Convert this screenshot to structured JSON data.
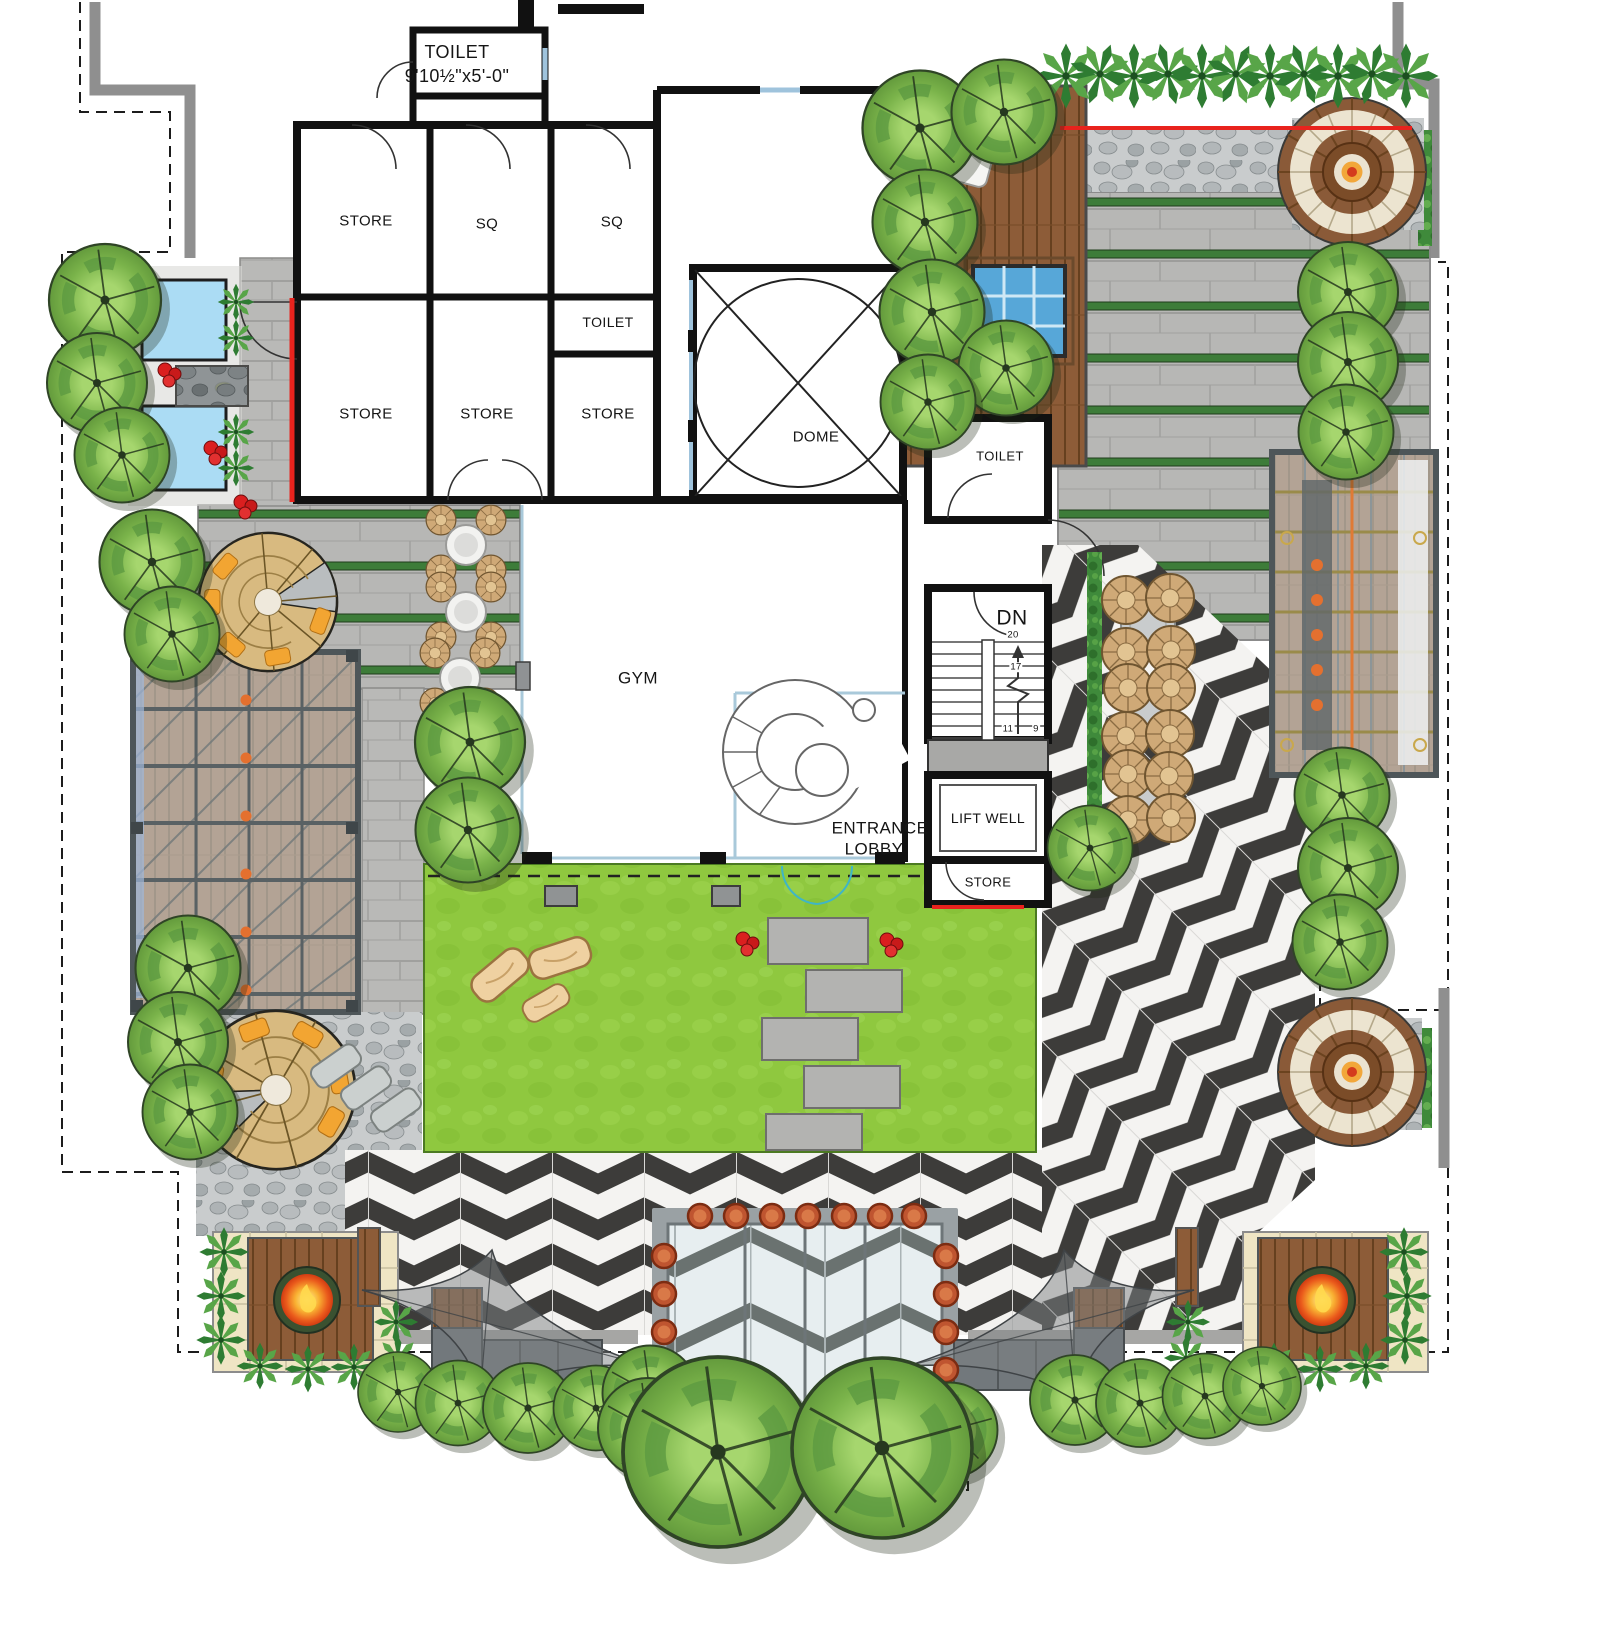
{
  "rooms": {
    "toilet_top": {
      "label": "TOILET",
      "dims": "9'10½\"x5'-0\""
    },
    "store_1": "STORE",
    "sq_1": "SQ",
    "sq_2": "SQ",
    "toilet_mid": "TOILET",
    "store_2": "STORE",
    "store_3": "STORE",
    "store_4": "STORE",
    "dome": "DOME",
    "gym": "GYM",
    "entrance_lobby": {
      "line1": "ENTRANCE",
      "line2": "LOBBY"
    },
    "toilet_core": "TOILET",
    "stair": {
      "label": "DN",
      "tread_20": "20",
      "tread_17": "17",
      "tread_11": "11",
      "tread_9": "9"
    },
    "lift_well": "LIFT WELL",
    "store_core": "STORE"
  },
  "colors": {
    "wall": "#111111",
    "red_accent": "#e8231d",
    "lawn": "#8fc83f",
    "chevron_dark": "#3d3c3a",
    "chevron_light": "#f4f3f1",
    "paver_gray": "#b7b7b5",
    "joint_green": "#3d7c39",
    "wood_brown": "#8d5c38",
    "water_blue": "#abdcf4",
    "spa_blue": "#57a7d8",
    "glass": "#e0e8ea",
    "fire_orange": "#f59d1f",
    "pot_terracotta": "#bf5530",
    "tree_green": "#7fb94e",
    "pebble_gray": "#c9cccd",
    "window_blue": "#9fc3dc",
    "door_teal": "#3fb5c6"
  },
  "features": {
    "water_feature": "water-feature",
    "pergola_left": "pergola",
    "pergola_right": "pergola",
    "spiral_lounge_upper": "spiral-lounge",
    "spiral_lounge_lower": "spiral-lounge",
    "fire_pit_left": "fire-pit",
    "fire_pit_right": "fire-pit",
    "round_fire_lounge_top": "round-fire-lounge",
    "round_fire_lounge_bottom": "round-fire-lounge",
    "sail_canopy_left": "sail-canopy",
    "sail_canopy_right": "sail-canopy",
    "glass_canopy": "glass-canopy",
    "spa": "spa",
    "sun_lounger": "sun-lounger",
    "lawn": "lawn",
    "stepping_stones": "stepping-stones",
    "chevron_deck": "chevron-deck",
    "paver_terrace": "paver-terrace",
    "wood_deck": "wood-deck",
    "hedge": "hedge",
    "trees": "trees",
    "wicker_stools": "wicker-stools",
    "cafe_tables": "cafe-tables",
    "boulders": "boulders",
    "flower_shrubs": "flower-shrubs"
  }
}
